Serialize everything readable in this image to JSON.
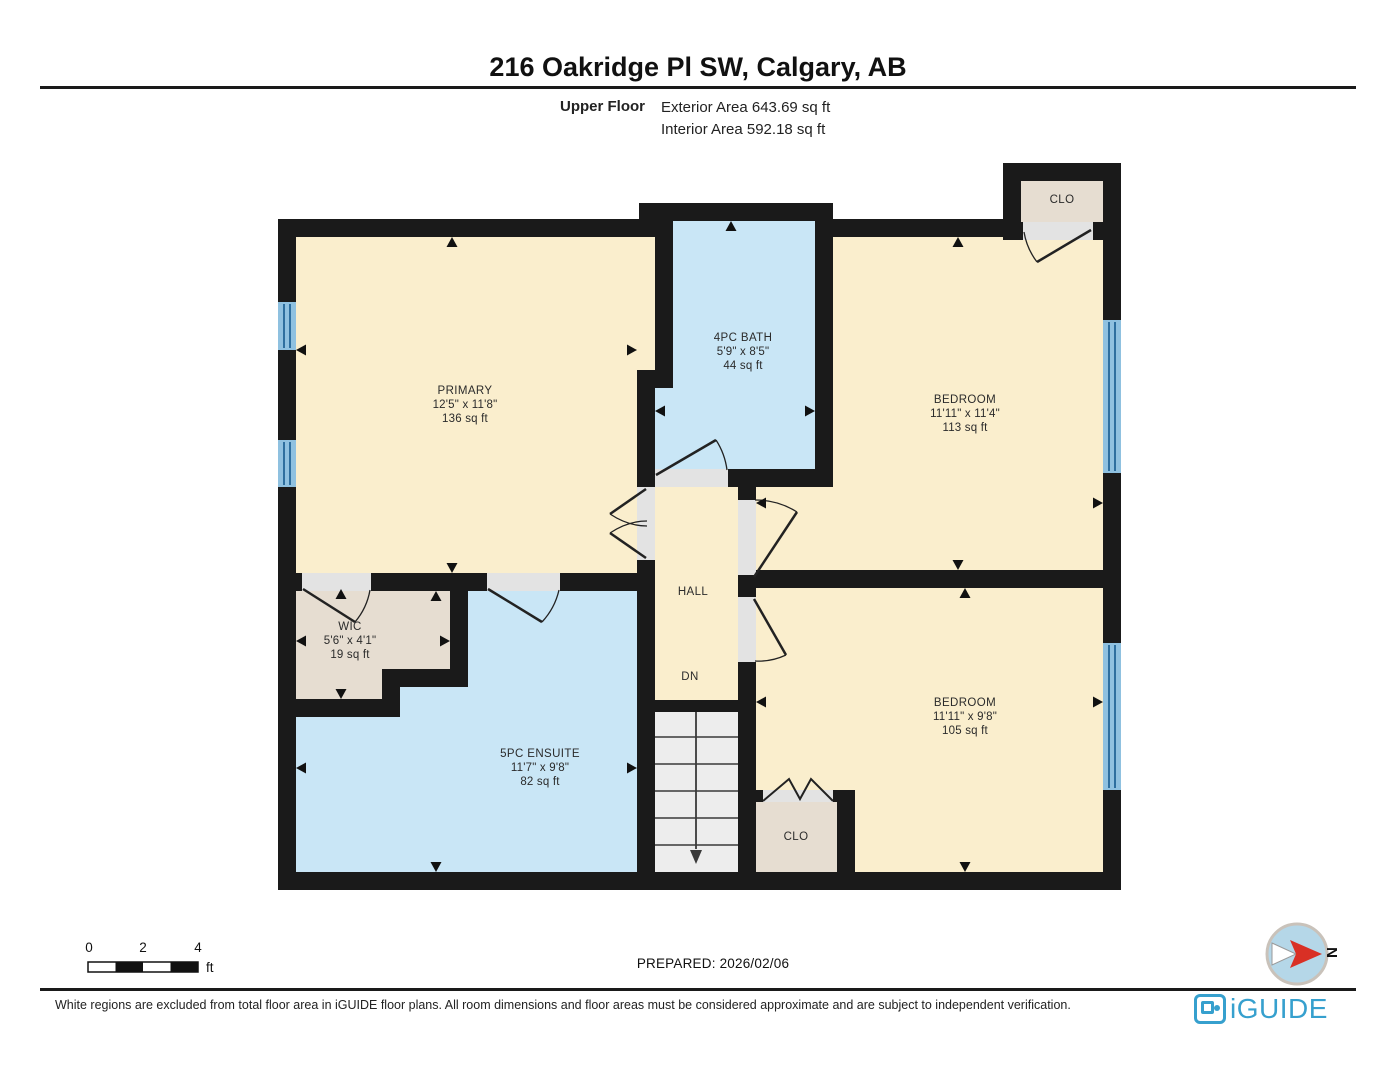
{
  "header": {
    "title": "216 Oakridge Pl SW, Calgary, AB",
    "floor_label": "Upper Floor",
    "exterior_area": "Exterior Area 643.69 sq ft",
    "interior_area": "Interior Area 592.18 sq ft"
  },
  "rooms": [
    {
      "name": "PRIMARY",
      "dims": "12'5\" x 11'8\"",
      "area": "136 sq ft"
    },
    {
      "name": "4PC BATH",
      "dims": "5'9\" x 8'5\"",
      "area": "44 sq ft"
    },
    {
      "name": "BEDROOM",
      "dims": "11'11\" x 11'4\"",
      "area": "113 sq ft"
    },
    {
      "name": "WIC",
      "dims": "5'6\" x 4'1\"",
      "area": "19 sq ft"
    },
    {
      "name": "5PC ENSUITE",
      "dims": "11'7\" x 9'8\"",
      "area": "82 sq ft"
    },
    {
      "name": "BEDROOM",
      "dims": "11'11\" x 9'8\"",
      "area": "105 sq ft"
    }
  ],
  "labels": {
    "hall": "HALL",
    "down": "DN",
    "closet_top": "CLO",
    "closet_bottom": "CLO"
  },
  "scale_bar": {
    "ticks": [
      "0",
      "2",
      "4"
    ],
    "unit": "ft"
  },
  "prepared": "PREPARED: 2026/02/06",
  "compass": {
    "north_label": "N"
  },
  "footer": {
    "disclaimer": "White regions are excluded from total floor area in iGUIDE floor plans. All room dimensions and floor areas must be considered approximate and are subject to independent verification.",
    "brand": "iGUIDE"
  },
  "colors": {
    "wall": "#1a1a1a",
    "room_fill": "#faeecd",
    "wet_room_fill": "#c9e6f6",
    "closet_fill": "#e6ddd1",
    "window_fill": "#8fc1e0",
    "window_stripe": "#2e6f9f",
    "door_gap": "#e3e3e3",
    "stairs_fill": "#ededed",
    "brand_blue": "#36a0ce",
    "compass_red": "#d93025"
  }
}
